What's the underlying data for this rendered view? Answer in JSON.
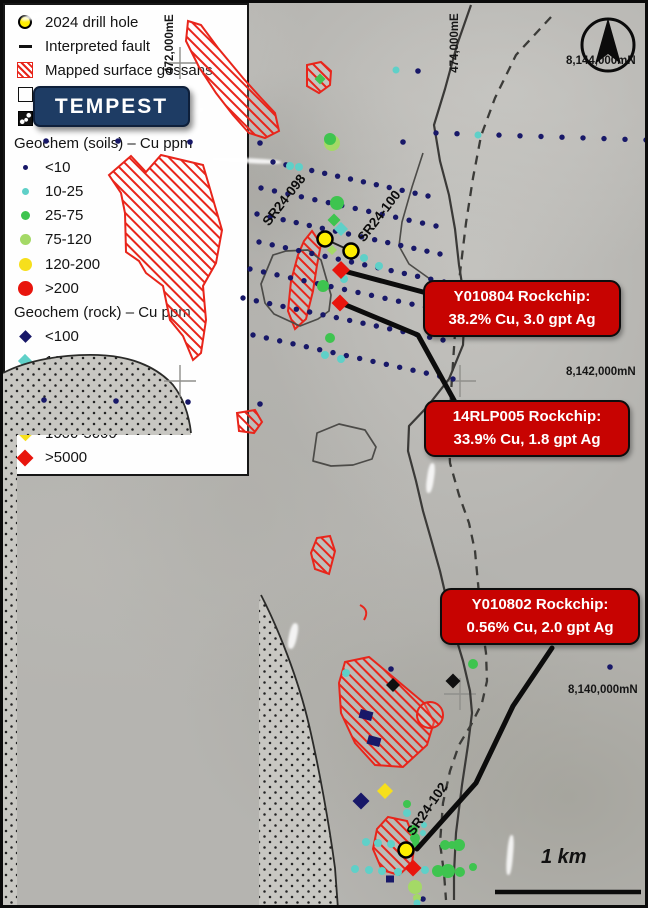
{
  "title": {
    "project": "TEMPEST"
  },
  "colors": {
    "navy": "#181868",
    "teal": "#5fd0c8",
    "green": "#3ec44f",
    "lgreen": "#a4d966",
    "yellow": "#f6df1c",
    "red": "#e8150d",
    "black": "#101010",
    "drill_fill": "#ffee00",
    "gossan": "#e8251b",
    "callout_bg": "#c70301",
    "banner_bg": "#1e3c64"
  },
  "grid": {
    "easting": [
      "472,000mE",
      "474,000mE"
    ],
    "northing": [
      "8,144,000mN",
      "8,142,000mN",
      "8,140,000mN"
    ]
  },
  "scale_bar": {
    "label": "1 km"
  },
  "drill_labels": [
    "SR24-098",
    "SR24-100",
    "SR24-102"
  ],
  "callouts": [
    {
      "title": "Y010804 Rockchip:",
      "value": "38.2% Cu, 3.0 gpt Ag"
    },
    {
      "title": "14RLP005 Rockchip:",
      "value": "33.9% Cu, 1.8 gpt Ag"
    },
    {
      "title": "Y010802 Rockchip:",
      "value": "0.56% Cu, 2.0 gpt Ag"
    }
  ],
  "legend": {
    "items": [
      {
        "type": "drill",
        "label": "2024 drill hole"
      },
      {
        "type": "dash",
        "label": "Interpreted fault"
      },
      {
        "type": "hatch",
        "label": "Mapped surface gossans"
      },
      {
        "type": "contact",
        "label": "Allen Bay contact"
      },
      {
        "type": "proto",
        "label": "Proterozoic (undiff)"
      },
      {
        "type": "header",
        "label": "Geochem (soils) – Cu ppm"
      },
      {
        "type": "dot",
        "color": "navy",
        "size": 5,
        "label": "<10"
      },
      {
        "type": "dot",
        "color": "teal",
        "size": 7,
        "label": "10-25"
      },
      {
        "type": "dot",
        "color": "green",
        "size": 9,
        "label": "25-75"
      },
      {
        "type": "dot",
        "color": "lgreen",
        "size": 11,
        "label": "75-120"
      },
      {
        "type": "dot",
        "color": "yellow",
        "size": 13,
        "label": "120-200"
      },
      {
        "type": "dot",
        "color": "red",
        "size": 15,
        "label": ">200"
      },
      {
        "type": "header",
        "label": "Geochem (rock) – Cu ppm"
      },
      {
        "type": "diamond",
        "color": "navy",
        "size": 9,
        "label": "<100"
      },
      {
        "type": "diamond",
        "color": "teal",
        "size": 10,
        "label": "100-200"
      },
      {
        "type": "diamond",
        "color": "green",
        "size": 11,
        "label": "200-500"
      },
      {
        "type": "diamond",
        "color": "lgreen",
        "size": 11,
        "label": "50-1000"
      },
      {
        "type": "diamond",
        "color": "yellow",
        "size": 11,
        "label": "1000-5000"
      },
      {
        "type": "diamond",
        "color": "red",
        "size": 12,
        "label": ">5000"
      }
    ]
  },
  "map_markers": {
    "soil_rows": [
      {
        "x1": 270,
        "y1": 159,
        "x2": 425,
        "y2": 193,
        "n": 13
      },
      {
        "x1": 258,
        "y1": 185,
        "x2": 433,
        "y2": 223,
        "n": 14
      },
      {
        "x1": 254,
        "y1": 211,
        "x2": 437,
        "y2": 251,
        "n": 15
      },
      {
        "x1": 256,
        "y1": 239,
        "x2": 441,
        "y2": 279,
        "n": 15
      },
      {
        "x1": 247,
        "y1": 266,
        "x2": 436,
        "y2": 307,
        "n": 15
      },
      {
        "x1": 240,
        "y1": 295,
        "x2": 440,
        "y2": 337,
        "n": 16
      },
      {
        "x1": 250,
        "y1": 332,
        "x2": 450,
        "y2": 376,
        "n": 16
      },
      {
        "x1": 433,
        "y1": 130,
        "x2": 643,
        "y2": 137,
        "n": 11
      }
    ],
    "navy_dots": [
      {
        "x": 43,
        "y": 138
      },
      {
        "x": 115,
        "y": 138
      },
      {
        "x": 187,
        "y": 139
      },
      {
        "x": 257,
        "y": 140
      },
      {
        "x": 400,
        "y": 139
      },
      {
        "x": 415,
        "y": 68
      },
      {
        "x": 41,
        "y": 397
      },
      {
        "x": 113,
        "y": 398
      },
      {
        "x": 185,
        "y": 399
      },
      {
        "x": 257,
        "y": 401
      },
      {
        "x": 388,
        "y": 666
      },
      {
        "x": 607,
        "y": 664
      },
      {
        "x": 420,
        "y": 896
      }
    ],
    "teal_dots": [
      {
        "x": 287,
        "y": 163,
        "r": 4
      },
      {
        "x": 296,
        "y": 164,
        "r": 4
      },
      {
        "x": 393,
        "y": 67,
        "r": 3.5
      },
      {
        "x": 475,
        "y": 132,
        "r": 3.5
      },
      {
        "x": 361,
        "y": 255,
        "r": 4
      },
      {
        "x": 376,
        "y": 263,
        "r": 4
      },
      {
        "x": 341,
        "y": 276,
        "r": 4
      },
      {
        "x": 322,
        "y": 352,
        "r": 4
      },
      {
        "x": 338,
        "y": 356,
        "r": 4
      },
      {
        "x": 343,
        "y": 670,
        "r": 4
      },
      {
        "x": 404,
        "y": 810,
        "r": 4
      },
      {
        "x": 421,
        "y": 822,
        "r": 3
      },
      {
        "x": 420,
        "y": 830,
        "r": 3
      },
      {
        "x": 363,
        "y": 839,
        "r": 4
      },
      {
        "x": 375,
        "y": 840,
        "r": 4
      },
      {
        "x": 388,
        "y": 841,
        "r": 4
      },
      {
        "x": 352,
        "y": 866,
        "r": 4
      },
      {
        "x": 366,
        "y": 867,
        "r": 4
      },
      {
        "x": 379,
        "y": 868,
        "r": 4
      },
      {
        "x": 395,
        "y": 869,
        "r": 4
      },
      {
        "x": 422,
        "y": 867,
        "r": 4
      },
      {
        "x": 414,
        "y": 900,
        "r": 3.5
      }
    ],
    "lgreen_dots": [
      {
        "x": 329,
        "y": 140,
        "r": 8
      },
      {
        "x": 412,
        "y": 884,
        "r": 7
      },
      {
        "x": 414,
        "y": 895,
        "r": 4
      }
    ],
    "green_dots": [
      {
        "x": 334,
        "y": 200,
        "r": 7
      },
      {
        "x": 327,
        "y": 136,
        "r": 6
      },
      {
        "x": 320,
        "y": 283,
        "r": 6
      },
      {
        "x": 327,
        "y": 335,
        "r": 5
      },
      {
        "x": 470,
        "y": 661,
        "r": 5
      },
      {
        "x": 404,
        "y": 801,
        "r": 4
      },
      {
        "x": 410,
        "y": 827,
        "r": 5
      },
      {
        "x": 412,
        "y": 835,
        "r": 5
      },
      {
        "x": 413,
        "y": 841,
        "r": 4
      },
      {
        "x": 442,
        "y": 842,
        "r": 5
      },
      {
        "x": 449,
        "y": 842,
        "r": 4
      },
      {
        "x": 456,
        "y": 842,
        "r": 6
      },
      {
        "x": 435,
        "y": 868,
        "r": 6
      },
      {
        "x": 445,
        "y": 868,
        "r": 7
      },
      {
        "x": 457,
        "y": 869,
        "r": 5
      },
      {
        "x": 470,
        "y": 864,
        "r": 4
      }
    ],
    "diamonds": [
      {
        "x": 338,
        "y": 226,
        "s": 7,
        "c": "teal"
      },
      {
        "x": 331,
        "y": 217,
        "s": 6.5,
        "c": "green"
      },
      {
        "x": 317,
        "y": 76,
        "s": 5.5,
        "c": "green"
      },
      {
        "x": 329,
        "y": 247,
        "s": 5,
        "c": "lgreen"
      },
      {
        "x": 382,
        "y": 788,
        "s": 8,
        "c": "yellow"
      },
      {
        "x": 358,
        "y": 798,
        "s": 8.5,
        "c": "navy"
      },
      {
        "x": 390,
        "y": 682,
        "s": 7,
        "c": "black"
      },
      {
        "x": 450,
        "y": 678,
        "s": 7.5,
        "c": "black"
      }
    ],
    "red_diamonds": [
      {
        "x": 338,
        "y": 267,
        "s": 9
      },
      {
        "x": 337,
        "y": 300,
        "s": 8.5
      },
      {
        "x": 410,
        "y": 865,
        "s": 8.5
      }
    ],
    "navy_rects": [
      {
        "x": 363,
        "y": 712,
        "w": 13,
        "h": 9,
        "rot": 15
      },
      {
        "x": 371,
        "y": 738,
        "w": 13,
        "h": 9,
        "rot": 15
      },
      {
        "x": 387,
        "y": 876,
        "w": 8,
        "h": 7,
        "rot": 0
      }
    ],
    "drill_holes": [
      {
        "x": 322,
        "y": 236
      },
      {
        "x": 348,
        "y": 248
      },
      {
        "x": 403,
        "y": 847
      }
    ]
  }
}
